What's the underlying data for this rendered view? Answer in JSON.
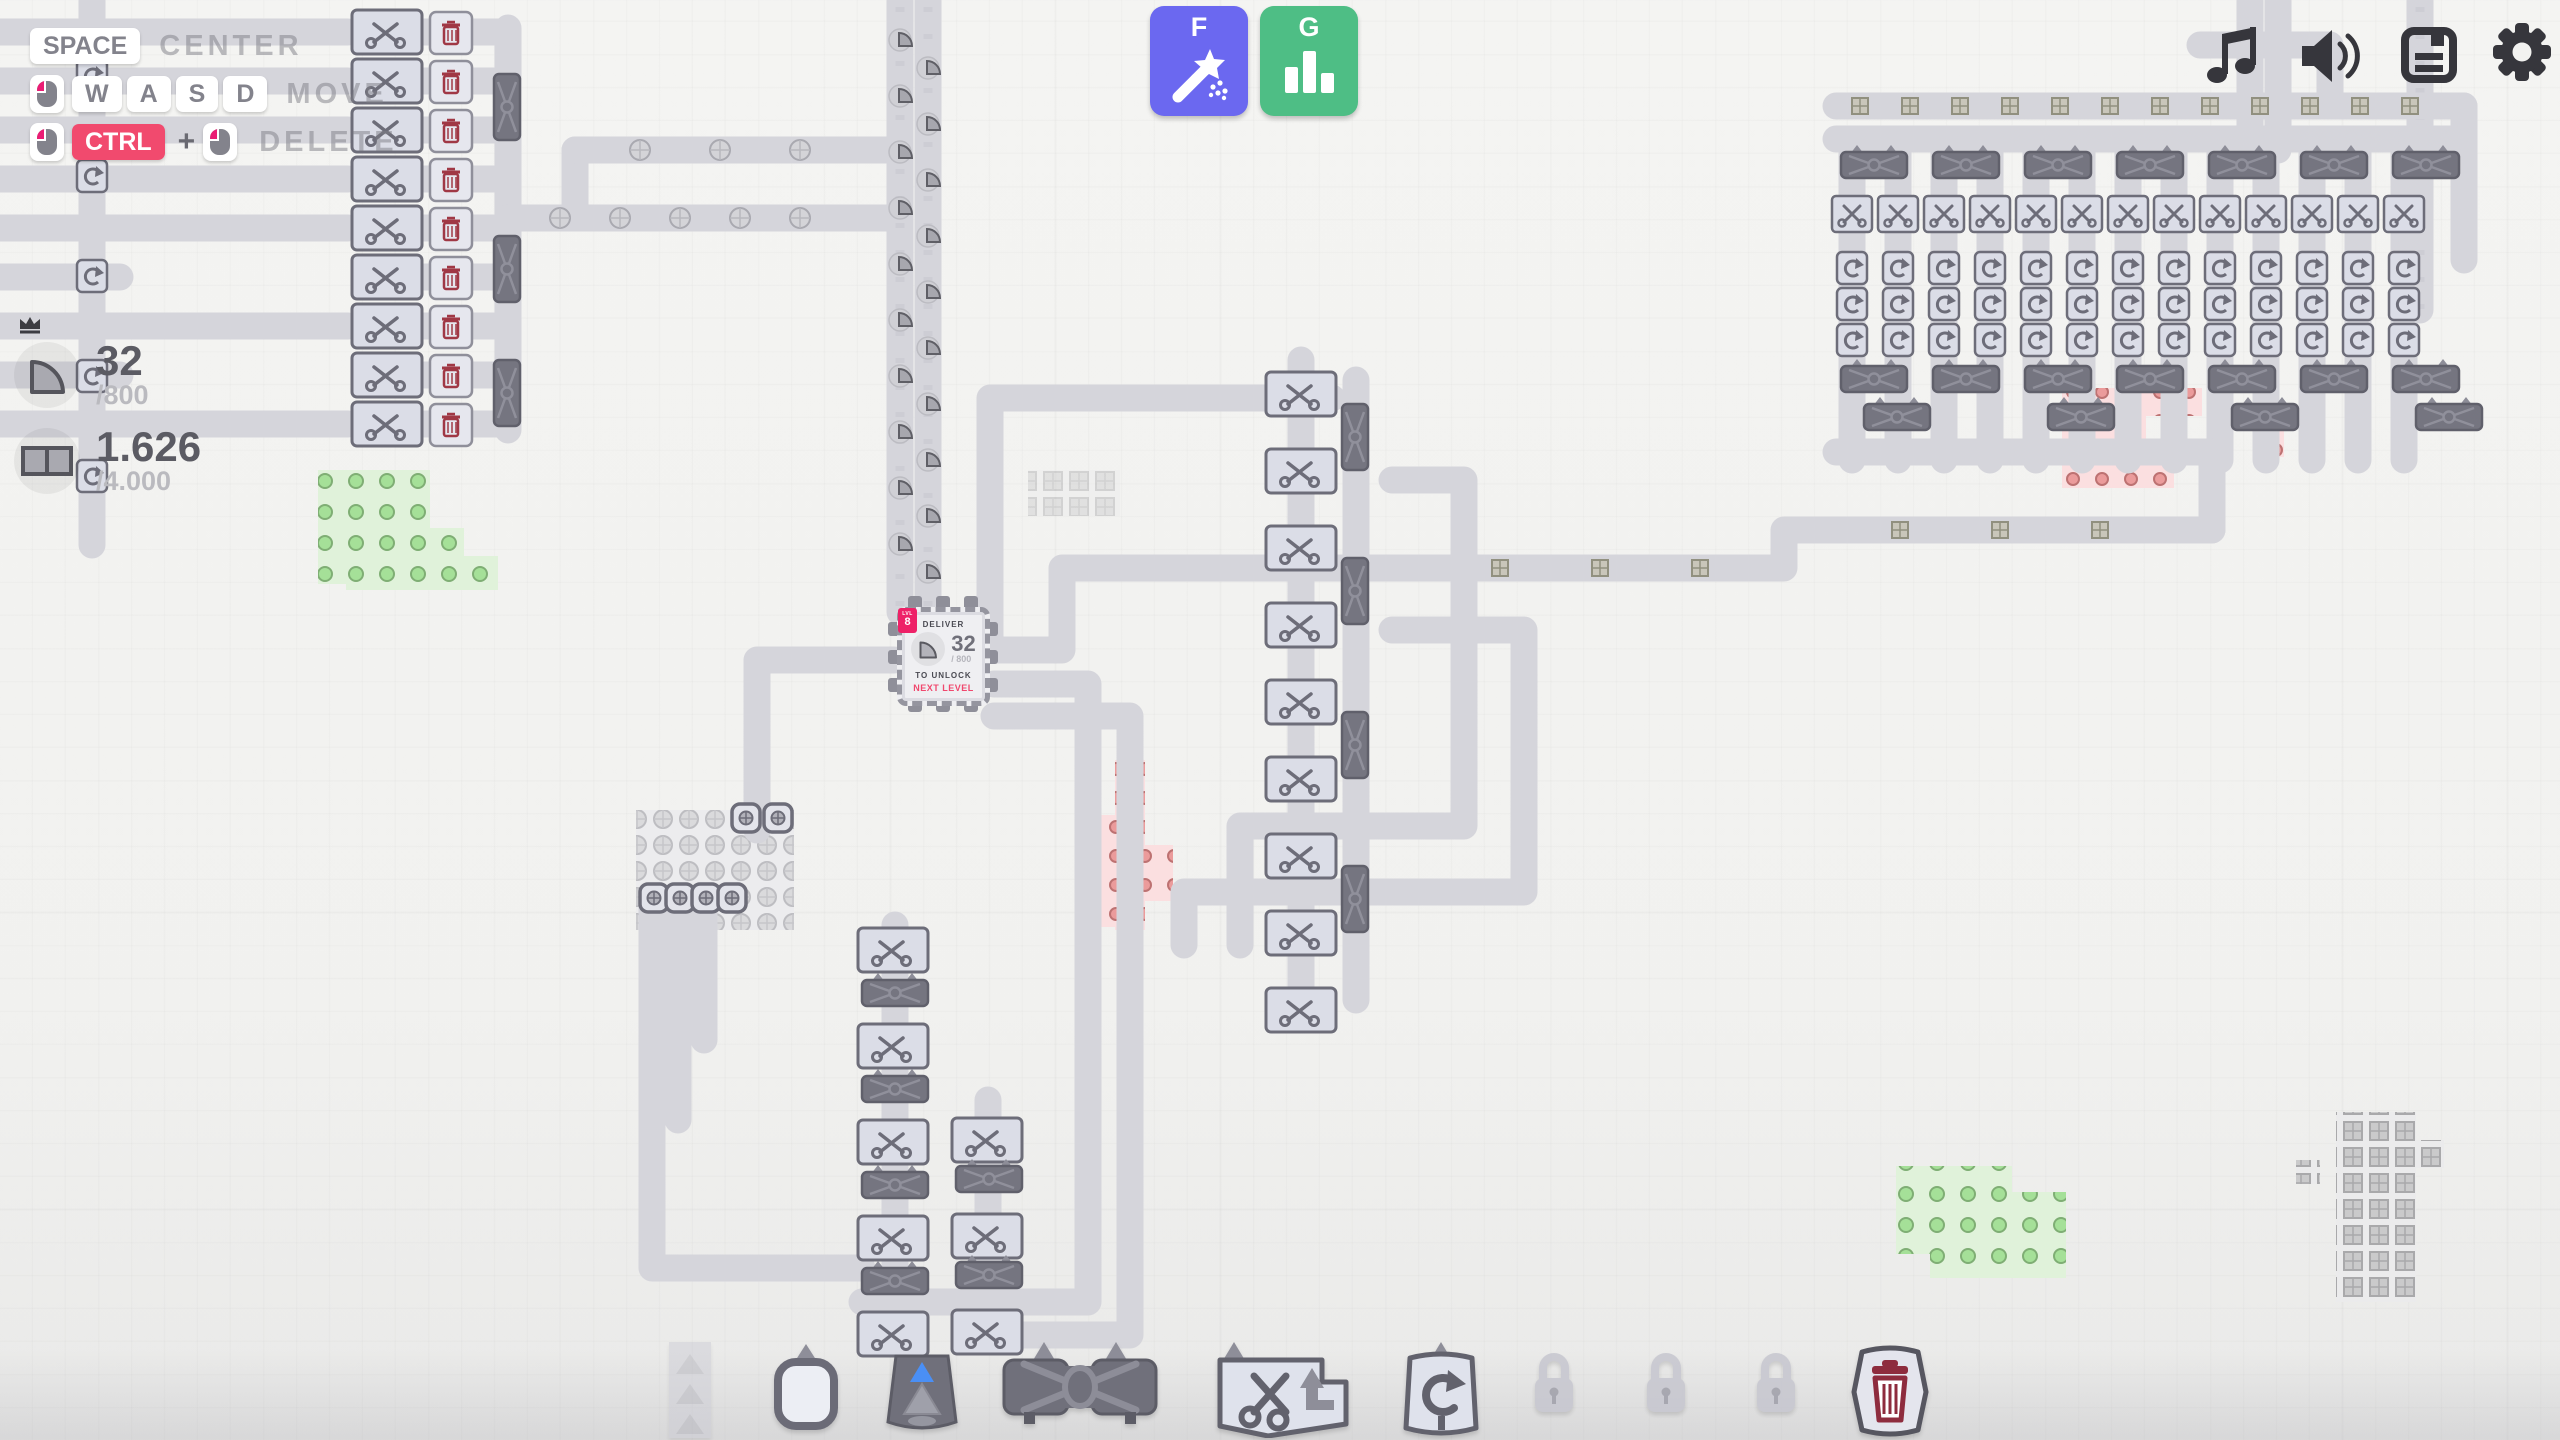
{
  "app": {
    "name": "shapez factory game"
  },
  "hints": {
    "row1": {
      "key": "SPACE",
      "label": "CENTER"
    },
    "row2": {
      "mouse": "left-mouse-button",
      "keys": [
        "W",
        "A",
        "S",
        "D"
      ],
      "label": "MOVE"
    },
    "row3": {
      "mouse": "left-mouse-button",
      "key": "CTRL",
      "plus": "+",
      "mouse2": "left-mouse-button",
      "label": "DELETE"
    }
  },
  "pins": [
    {
      "shape": "quarter-circle",
      "value": "32",
      "goal": "/800",
      "crowned": true
    },
    {
      "shape": "double-square",
      "value": "1.626",
      "goal": "/4.000",
      "crowned": false
    }
  ],
  "hotkeys": [
    {
      "key": "F",
      "icon": "magic-wand-icon",
      "color": "#6b68f0"
    },
    {
      "key": "G",
      "icon": "statistics-icon",
      "color": "#4ebe85"
    }
  ],
  "window_icons": [
    {
      "icon": "music-note-icon"
    },
    {
      "icon": "speaker-icon"
    },
    {
      "icon": "save-icon"
    },
    {
      "icon": "settings-gear-icon"
    }
  ],
  "hub": {
    "level_caption": "LVL",
    "level": "8",
    "line1": "DELIVER",
    "shape": "quarter-circle",
    "amount": "32",
    "capacity": "/ 800",
    "line2": "TO UNLOCK",
    "line3": "NEXT LEVEL",
    "accent": "#ee2168"
  },
  "toolbar": [
    {
      "name": "belt",
      "icon": "belt-icon",
      "state": "dimmed"
    },
    {
      "name": "extractor",
      "icon": "extractor-icon",
      "state": "normal"
    },
    {
      "name": "tunnel",
      "icon": "tunnel-icon",
      "state": "normal"
    },
    {
      "name": "balancer",
      "icon": "balancer-icon",
      "state": "normal"
    },
    {
      "name": "cutter",
      "icon": "cutter-icon",
      "state": "normal"
    },
    {
      "name": "rotator",
      "icon": "rotator-icon",
      "state": "normal"
    },
    {
      "name": "locked-slot",
      "icon": "lock-icon",
      "state": "locked"
    },
    {
      "name": "locked-slot",
      "icon": "lock-icon",
      "state": "locked"
    },
    {
      "name": "locked-slot",
      "icon": "lock-icon",
      "state": "locked"
    },
    {
      "name": "trash",
      "icon": "trash-icon",
      "state": "normal"
    }
  ],
  "colors": {
    "accent_pink": "#ee2168",
    "key_red": "#f14a6e",
    "hint_text": "#7e7e86",
    "belt": "#d5d5db",
    "machine_light": "#dbdde7",
    "machine_dark": "#757580",
    "resource_green": "#a5e098",
    "resource_red": "#eb9b9b",
    "ui_dark": "#36363c"
  }
}
